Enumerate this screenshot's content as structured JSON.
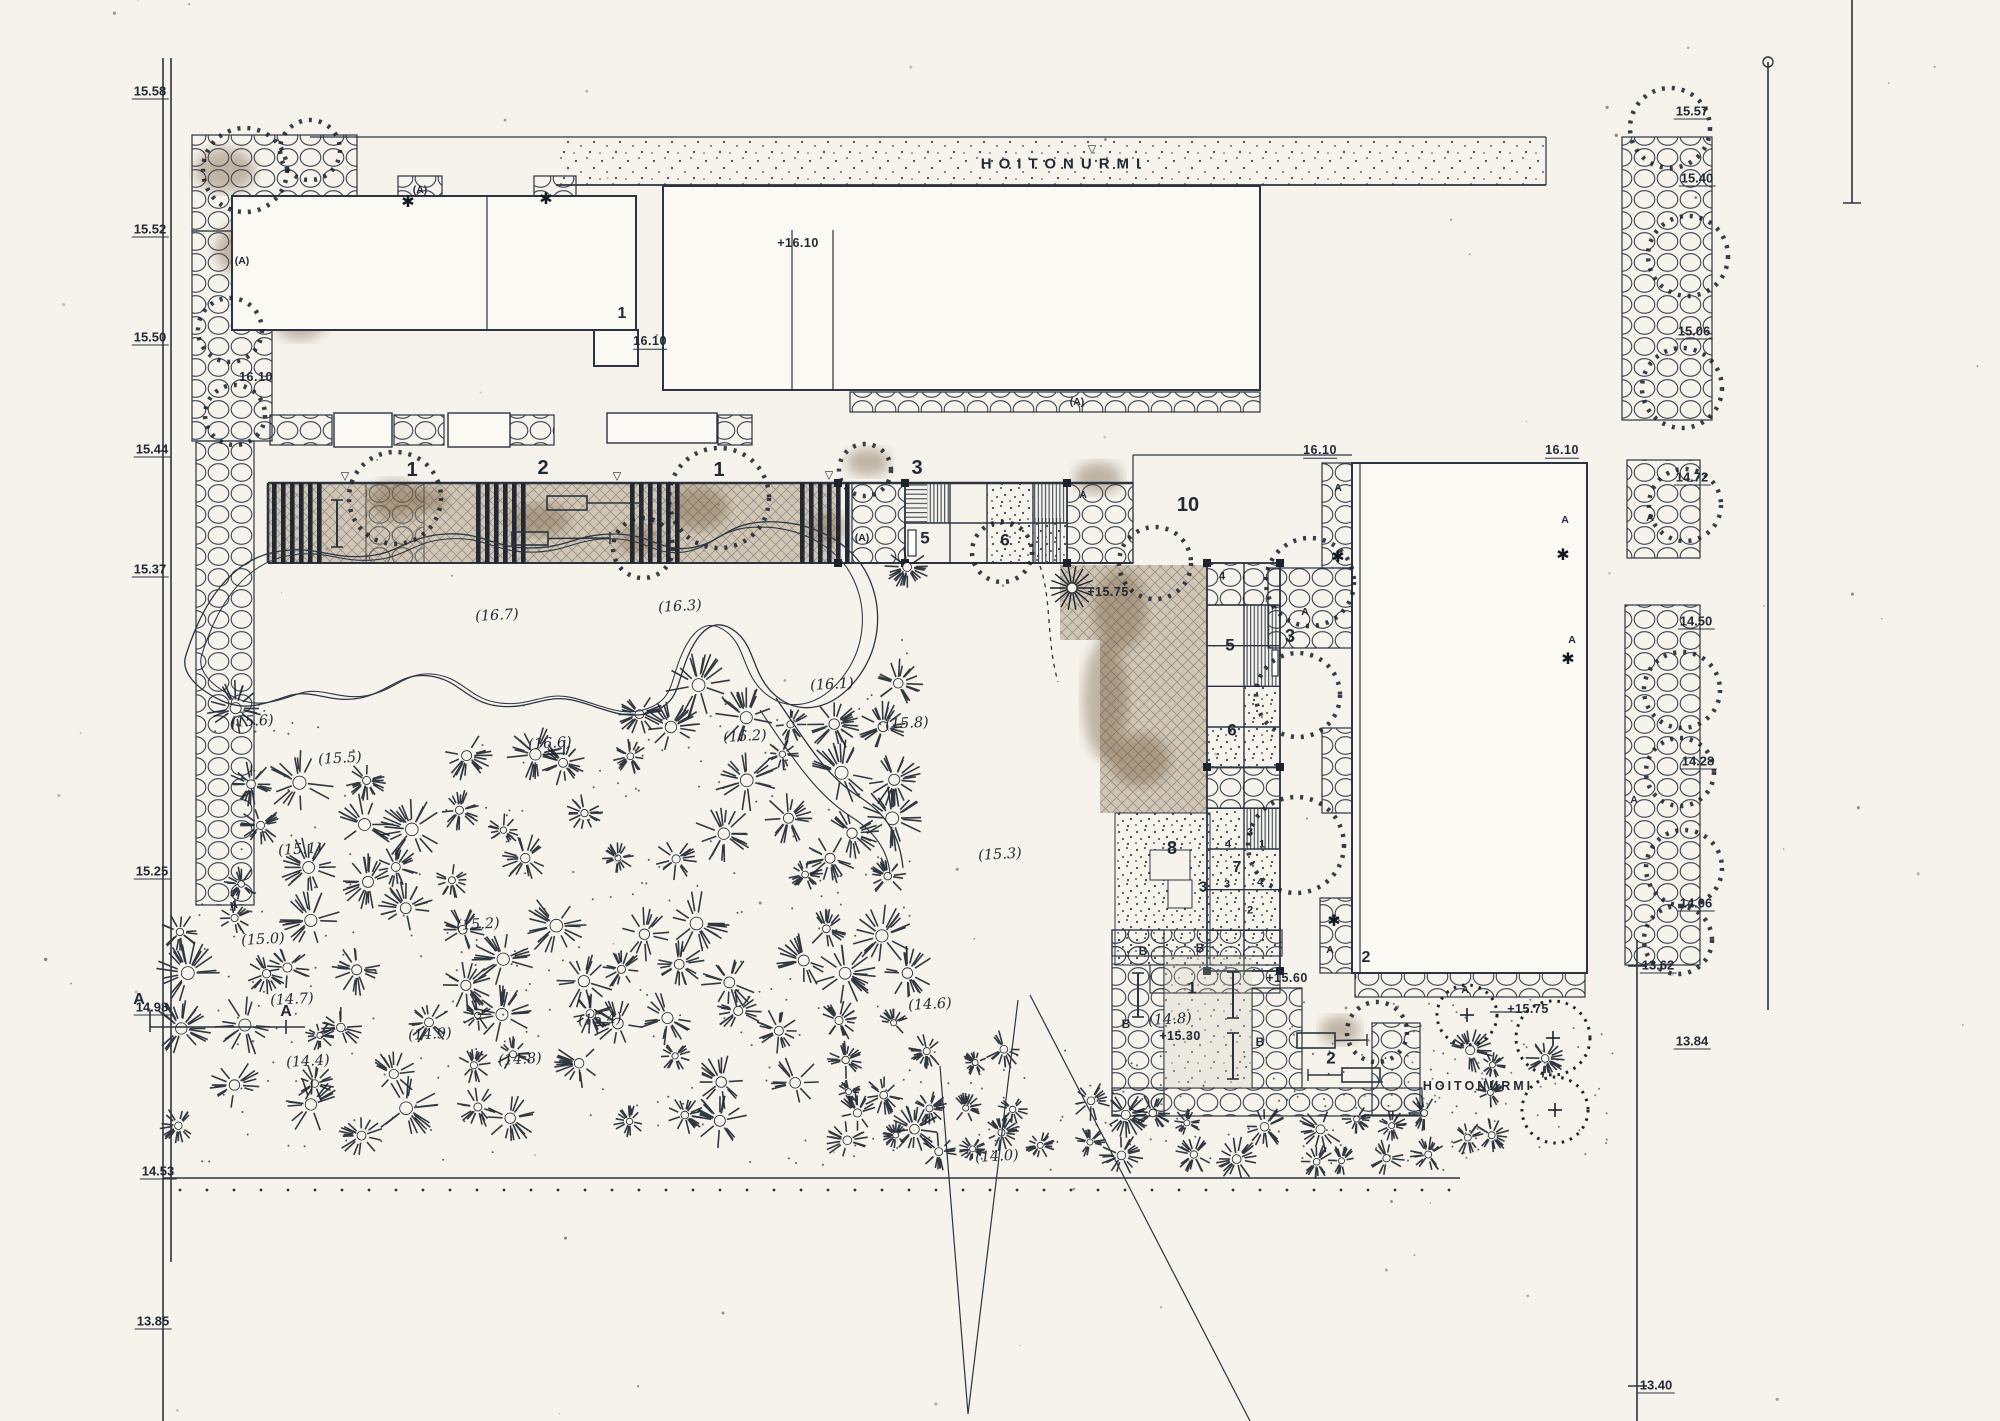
{
  "drawing": {
    "kind": "landscape site plan (scanned)",
    "language": "Finnish"
  },
  "colors": {
    "paper": "#f5f3ec",
    "ink": "#2b3440",
    "sepia": "#a8906f",
    "stain": "#6b4f33",
    "hatch": "#5d6672"
  },
  "symbols": {
    "conifer": "✱",
    "spot_height_triangle": "▽",
    "deciduous_tree": "dashed-circle",
    "existing_shrub": "starburst-circle",
    "paving": "circle-grid",
    "lawn": "stipple"
  },
  "texts": {
    "lawn_label_top": "HOITONURMI",
    "lawn_label_bottom": "HOITONURMI"
  },
  "boundary_elevations_left": [
    {
      "text": "15.58",
      "x": 150,
      "y": 92
    },
    {
      "text": "15.52",
      "x": 150,
      "y": 230
    },
    {
      "text": "15.50",
      "x": 150,
      "y": 338
    },
    {
      "text": "15.44",
      "x": 152,
      "y": 450
    },
    {
      "text": "15.37",
      "x": 150,
      "y": 570
    },
    {
      "text": "15.25",
      "x": 152,
      "y": 872
    },
    {
      "text": "14.98",
      "x": 152,
      "y": 1008
    },
    {
      "text": "14.53",
      "x": 158,
      "y": 1172
    },
    {
      "text": "13.85",
      "x": 153,
      "y": 1322
    }
  ],
  "boundary_elevations_right": [
    {
      "text": "15.57",
      "x": 1692,
      "y": 112
    },
    {
      "text": "15.40",
      "x": 1697,
      "y": 179
    },
    {
      "text": "15.06",
      "x": 1694,
      "y": 332
    },
    {
      "text": "14.72",
      "x": 1692,
      "y": 478
    },
    {
      "text": "14.50",
      "x": 1696,
      "y": 622
    },
    {
      "text": "14.28",
      "x": 1698,
      "y": 762
    },
    {
      "text": "14.06",
      "x": 1696,
      "y": 904
    },
    {
      "text": "13.84",
      "x": 1692,
      "y": 1042
    },
    {
      "text": "13.62",
      "x": 1658,
      "y": 966
    },
    {
      "text": "13.40",
      "x": 1656,
      "y": 1386
    }
  ],
  "level_marks": [
    {
      "text": "+16.10",
      "x": 798,
      "y": 243,
      "u": false
    },
    {
      "text": "16.10",
      "x": 650,
      "y": 342,
      "u": true
    },
    {
      "text": "16.10",
      "x": 256,
      "y": 377,
      "u": false
    },
    {
      "text": "16.10",
      "x": 1320,
      "y": 451,
      "u": true
    },
    {
      "text": "16.10",
      "x": 1562,
      "y": 451,
      "u": true
    },
    {
      "text": "+15.75",
      "x": 1108,
      "y": 592,
      "u": false
    },
    {
      "text": "+15.60",
      "x": 1287,
      "y": 978,
      "u": false
    },
    {
      "text": "+15.30",
      "x": 1180,
      "y": 1036,
      "u": false
    },
    {
      "text": "+15.75",
      "x": 1528,
      "y": 1009,
      "u": false
    }
  ],
  "spot_elevations": [
    {
      "text": "(16.7)",
      "x": 497,
      "y": 616
    },
    {
      "text": "(16.3)",
      "x": 680,
      "y": 607
    },
    {
      "text": "(16.6)",
      "x": 550,
      "y": 744
    },
    {
      "text": "(16.2)",
      "x": 745,
      "y": 737
    },
    {
      "text": "(16.1)",
      "x": 832,
      "y": 685
    },
    {
      "text": "(15.8)",
      "x": 907,
      "y": 724
    },
    {
      "text": "(15.6)",
      "x": 252,
      "y": 722
    },
    {
      "text": "(15.5)",
      "x": 340,
      "y": 759
    },
    {
      "text": "(15.1)",
      "x": 300,
      "y": 850
    },
    {
      "text": "(15.2)",
      "x": 478,
      "y": 925
    },
    {
      "text": "(15.0)",
      "x": 263,
      "y": 940
    },
    {
      "text": "(14.7)",
      "x": 292,
      "y": 1000
    },
    {
      "text": "(14.4)",
      "x": 308,
      "y": 1062
    },
    {
      "text": "(14.9)",
      "x": 430,
      "y": 1035
    },
    {
      "text": "(14.8)",
      "x": 520,
      "y": 1060
    },
    {
      "text": "(15.4)",
      "x": 600,
      "y": 1020
    },
    {
      "text": "(14.6)",
      "x": 930,
      "y": 1005
    },
    {
      "text": "(15.3)",
      "x": 1000,
      "y": 855
    },
    {
      "text": "(14.0)",
      "x": 997,
      "y": 1157
    },
    {
      "text": "(14.8)",
      "x": 1170,
      "y": 1020
    }
  ],
  "area_numbers": [
    {
      "text": "1",
      "x": 412,
      "y": 470,
      "size": 20
    },
    {
      "text": "2",
      "x": 543,
      "y": 468,
      "size": 20
    },
    {
      "text": "1",
      "x": 719,
      "y": 470,
      "size": 20
    },
    {
      "text": "3",
      "x": 917,
      "y": 468,
      "size": 20
    },
    {
      "text": "5",
      "x": 925,
      "y": 538,
      "size": 17
    },
    {
      "text": "6",
      "x": 1005,
      "y": 540,
      "size": 17
    },
    {
      "text": "10",
      "x": 1188,
      "y": 505,
      "size": 20
    },
    {
      "text": "1",
      "x": 622,
      "y": 314,
      "size": 16
    },
    {
      "text": "5",
      "x": 1230,
      "y": 645,
      "size": 17
    },
    {
      "text": "3",
      "x": 1290,
      "y": 636,
      "size": 18
    },
    {
      "text": "6",
      "x": 1232,
      "y": 730,
      "size": 17
    },
    {
      "text": "8",
      "x": 1172,
      "y": 848,
      "size": 18
    },
    {
      "text": "7",
      "x": 1237,
      "y": 868,
      "size": 16
    },
    {
      "text": "3",
      "x": 1203,
      "y": 887,
      "size": 15
    },
    {
      "text": "1",
      "x": 1192,
      "y": 988,
      "size": 17
    },
    {
      "text": "2",
      "x": 1366,
      "y": 958,
      "size": 16
    },
    {
      "text": "2",
      "x": 1331,
      "y": 1058,
      "size": 17
    }
  ],
  "cell_numbers": [
    {
      "text": "3",
      "x": 1250,
      "y": 833
    },
    {
      "text": "4",
      "x": 1228,
      "y": 845
    },
    {
      "text": "1",
      "x": 1262,
      "y": 845
    },
    {
      "text": "3",
      "x": 1227,
      "y": 885
    },
    {
      "text": "4",
      "x": 1260,
      "y": 883
    },
    {
      "text": "2",
      "x": 1250,
      "y": 911
    },
    {
      "text": "4",
      "x": 1222,
      "y": 577
    }
  ],
  "planting_markers": [
    {
      "text": "(A)",
      "x": 242,
      "y": 261
    },
    {
      "text": "(A)",
      "x": 420,
      "y": 190
    },
    {
      "text": "A",
      "x": 234,
      "y": 905
    },
    {
      "text": "(A)",
      "x": 1077,
      "y": 402
    },
    {
      "text": "(A)",
      "x": 862,
      "y": 538
    },
    {
      "text": "A",
      "x": 1083,
      "y": 495
    },
    {
      "text": "A",
      "x": 1305,
      "y": 612
    },
    {
      "text": "A",
      "x": 1338,
      "y": 488
    },
    {
      "text": "A",
      "x": 1565,
      "y": 520
    },
    {
      "text": "A",
      "x": 1572,
      "y": 640
    },
    {
      "text": "A",
      "x": 1330,
      "y": 950
    },
    {
      "text": "A",
      "x": 1465,
      "y": 990
    },
    {
      "text": "A",
      "x": 1650,
      "y": 518
    },
    {
      "text": "A",
      "x": 1634,
      "y": 800
    }
  ],
  "b_markers": [
    {
      "text": "B",
      "x": 1143,
      "y": 951
    },
    {
      "text": "B",
      "x": 1200,
      "y": 948
    },
    {
      "text": "B",
      "x": 1126,
      "y": 1024
    },
    {
      "text": "B",
      "x": 1260,
      "y": 1042
    }
  ],
  "section_markers": [
    {
      "text": "A",
      "x": 139,
      "y": 1000
    },
    {
      "text": "A",
      "x": 286,
      "y": 1012
    }
  ],
  "triangle_marks": [
    {
      "x": 345,
      "y": 477
    },
    {
      "x": 617,
      "y": 477
    },
    {
      "x": 829,
      "y": 476
    },
    {
      "x": 1092,
      "y": 150
    }
  ],
  "conifer_marks": [
    {
      "x": 408,
      "y": 203
    },
    {
      "x": 546,
      "y": 200
    },
    {
      "x": 1338,
      "y": 558
    },
    {
      "x": 1563,
      "y": 556
    },
    {
      "x": 1568,
      "y": 660
    },
    {
      "x": 1334,
      "y": 922
    }
  ]
}
